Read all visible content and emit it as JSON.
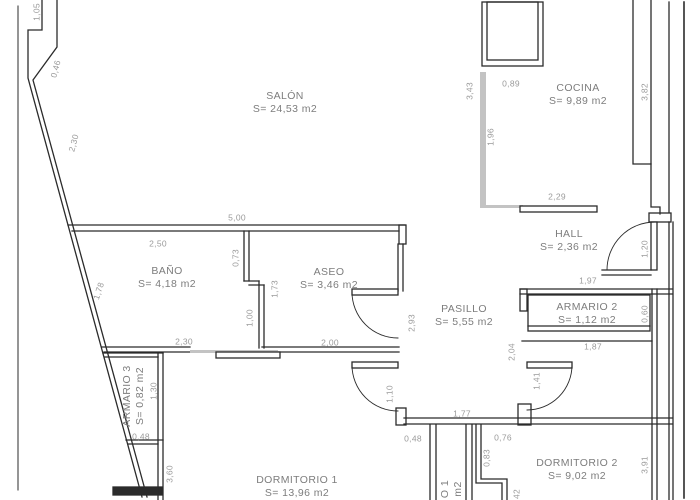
{
  "drawing": {
    "type": "apartment-floor-plan",
    "units_note": "m2",
    "colors": {
      "wall": "#2b2b2b",
      "light_element": "#c3c3c3",
      "room_text": "#7d7d7d",
      "dimension_text": "#9a9a9a",
      "background": "#ffffff"
    }
  },
  "rooms": [
    {
      "id": "salon",
      "label": "SALÓN",
      "area": "S= 24,53 m2",
      "x": 285,
      "y": 103,
      "rot": 0
    },
    {
      "id": "cocina",
      "label": "COCINA",
      "area": "S= 9,89 m2",
      "x": 578,
      "y": 95,
      "rot": 0
    },
    {
      "id": "hall",
      "label": "HALL",
      "area": "S= 2,36 m2",
      "x": 569,
      "y": 241,
      "rot": 0
    },
    {
      "id": "bano",
      "label": "BAÑO",
      "area": "S= 4,18 m2",
      "x": 167,
      "y": 278,
      "rot": 0
    },
    {
      "id": "aseo",
      "label": "ASEO",
      "area": "S= 3,46 m2",
      "x": 329,
      "y": 279,
      "rot": 0
    },
    {
      "id": "pasillo",
      "label": "PASILLO",
      "area": "S= 5,55 m2",
      "x": 464,
      "y": 316,
      "rot": 0
    },
    {
      "id": "armario2",
      "label": "ARMARIO 2",
      "area": "S= 1,12 m2",
      "x": 587,
      "y": 314,
      "rot": 0
    },
    {
      "id": "armario3",
      "label": "ARMARIO 3",
      "area": "S= 0,82 m2",
      "x": 134,
      "y": 396,
      "rot": -90
    },
    {
      "id": "dorm1",
      "label": "DORMITORIO 1",
      "area": "S= 13,96 m2",
      "x": 297,
      "y": 487,
      "rot": 0
    },
    {
      "id": "dorm2",
      "label": "DORMITORIO 2",
      "area": "S= 9,02 m2",
      "x": 577,
      "y": 470,
      "rot": 0
    },
    {
      "id": "room-frag",
      "label": "O 1",
      "area": "m2",
      "x": 452,
      "y": 489,
      "rot": -90
    }
  ],
  "dimensions": [
    {
      "text": "1,05",
      "x": 37,
      "y": 12,
      "rot": -90
    },
    {
      "text": "0,46",
      "x": 56,
      "y": 69,
      "rot": -75
    },
    {
      "text": "2,30",
      "x": 74,
      "y": 143,
      "rot": -75
    },
    {
      "text": "1,78",
      "x": 99,
      "y": 291,
      "rot": -72
    },
    {
      "text": "5,00",
      "x": 237,
      "y": 218,
      "rot": 0
    },
    {
      "text": "2,50",
      "x": 158,
      "y": 244,
      "rot": 0
    },
    {
      "text": "0,73",
      "x": 236,
      "y": 258,
      "rot": -90
    },
    {
      "text": "1,73",
      "x": 275,
      "y": 289,
      "rot": -90
    },
    {
      "text": "1,00",
      "x": 250,
      "y": 318,
      "rot": -90
    },
    {
      "text": "2,30",
      "x": 184,
      "y": 342,
      "rot": 0
    },
    {
      "text": "2,00",
      "x": 330,
      "y": 343,
      "rot": 0
    },
    {
      "text": "2,93",
      "x": 412,
      "y": 323,
      "rot": -90
    },
    {
      "text": "3,43",
      "x": 470,
      "y": 91,
      "rot": -90
    },
    {
      "text": "0,89",
      "x": 511,
      "y": 84,
      "rot": 0
    },
    {
      "text": "1,96",
      "x": 491,
      "y": 137,
      "rot": -90
    },
    {
      "text": "2,29",
      "x": 557,
      "y": 197,
      "rot": 0
    },
    {
      "text": "3,82",
      "x": 645,
      "y": 92,
      "rot": -90
    },
    {
      "text": "1,20",
      "x": 645,
      "y": 249,
      "rot": -90
    },
    {
      "text": "1,97",
      "x": 588,
      "y": 281,
      "rot": 0
    },
    {
      "text": "0,60",
      "x": 645,
      "y": 314,
      "rot": -90
    },
    {
      "text": "1,87",
      "x": 593,
      "y": 347,
      "rot": 0
    },
    {
      "text": "2,04",
      "x": 512,
      "y": 352,
      "rot": -90
    },
    {
      "text": "1,41",
      "x": 537,
      "y": 381,
      "rot": -90
    },
    {
      "text": "1,10",
      "x": 390,
      "y": 394,
      "rot": -90
    },
    {
      "text": "1,77",
      "x": 462,
      "y": 414,
      "rot": 0
    },
    {
      "text": "0,48",
      "x": 413,
      "y": 439,
      "rot": 0
    },
    {
      "text": "0,76",
      "x": 503,
      "y": 438,
      "rot": 0
    },
    {
      "text": "0,83",
      "x": 487,
      "y": 458,
      "rot": -90
    },
    {
      "text": "42",
      "x": 517,
      "y": 494,
      "rot": -90
    },
    {
      "text": "0,48",
      "x": 141,
      "y": 437,
      "rot": 0
    },
    {
      "text": "1,30",
      "x": 154,
      "y": 391,
      "rot": -90
    },
    {
      "text": "3,60",
      "x": 170,
      "y": 474,
      "rot": -90
    },
    {
      "text": "3,91",
      "x": 645,
      "y": 465,
      "rot": -90
    }
  ]
}
